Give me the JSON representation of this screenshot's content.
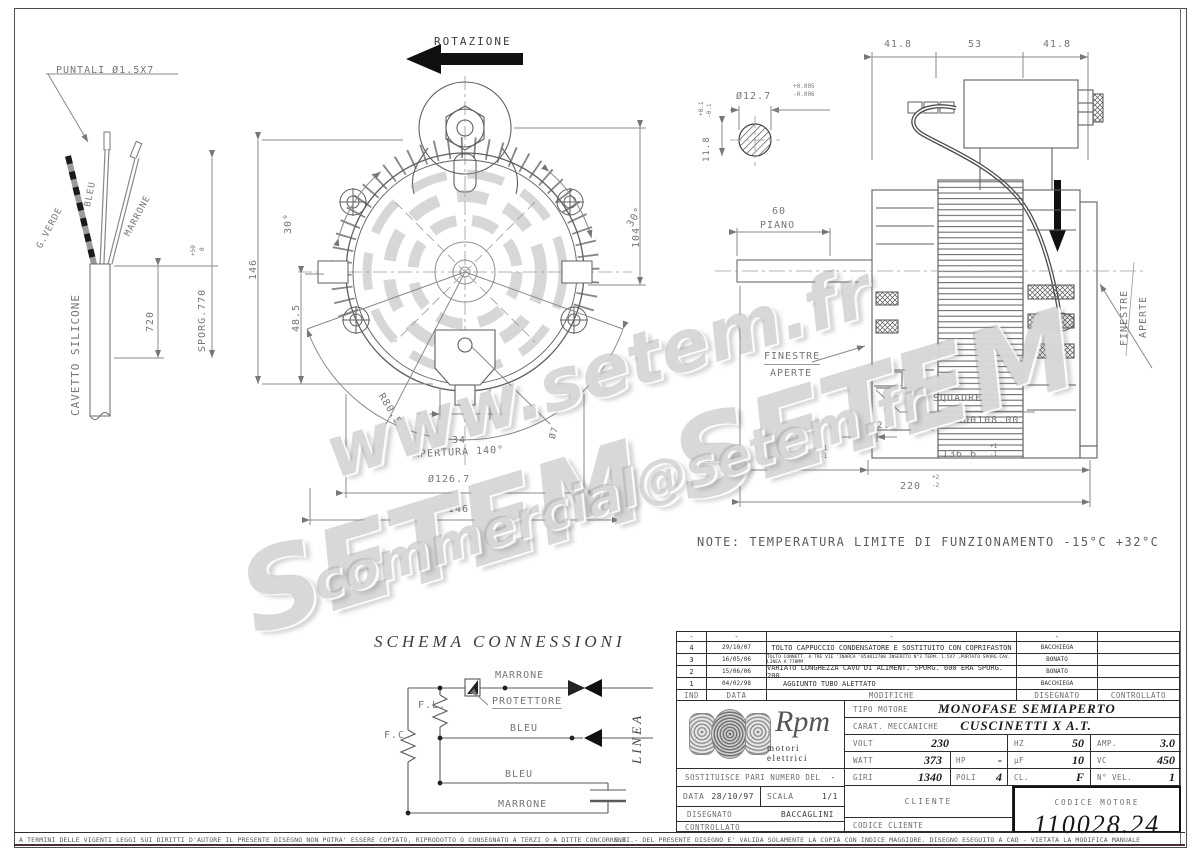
{
  "wm": {
    "line1": "www.setem.fr",
    "line2": "SETEM  SETEM",
    "line3": "commercial@setem.fr"
  },
  "cable": {
    "puntali": "PUNTALI Ø1.5X7",
    "g_verde": "G.VERDE",
    "bleu": "BLEU",
    "marrone": "MARRONE",
    "cavetto": "CAVETTO SILICONE",
    "d720": "720",
    "sporg": "SPORG.770",
    "sporg_tp": "+50",
    "sporg_tb": "0"
  },
  "front": {
    "rotazione": "ROTAZIONE",
    "d146l": "146",
    "d30l": "30°",
    "d48": "48.5",
    "d104": "104",
    "d30r": "30°",
    "r80": "R80.5",
    "d34": "34",
    "o7": "Ø7",
    "apertura": "APERTURA 140°",
    "o126": "Ø126.7",
    "d146b": "146"
  },
  "shaft": {
    "o127": "Ø12.7",
    "tol1a": "+0.005",
    "tol1b": "-0.006",
    "d118": "11.8",
    "tol2a": "+0.1",
    "tol2b": "-0.1"
  },
  "side": {
    "d418a": "41.8",
    "d53": "53",
    "d418b": "41.8",
    "d60": "60",
    "piano": "PIANO",
    "fin_l1": "FINESTRE",
    "fin_l2": "APERTE",
    "fin_r1": "FINESTRE",
    "fin_r2": "APERTE",
    "sq1": "SQUADRETTE",
    "sq2": "COD.300108.00",
    "d23": "2.3",
    "d834": "83.4",
    "t834a": "+1",
    "t834b": "-1",
    "d1366": "136.6",
    "t1366a": "+1",
    "t1366b": "-1",
    "d220": "220",
    "t220a": "+2",
    "t220b": "-2"
  },
  "note": "NOTE: TEMPERATURA LIMITE DI FUNZIONAMENTO -15°C +32°C",
  "schema": {
    "title": "SCHEMA CONNESSIONI",
    "marrone_top": "MARRONE",
    "protettore": "PROTETTORE",
    "fl": "F.L.",
    "fc": "F.C.",
    "bleu_mid": "BLEU",
    "bleu_low": "BLEU",
    "marrone_bot": "MARRONE",
    "linea": "LINEA"
  },
  "rev": {
    "hdr": {
      "ind": "IND",
      "data": "DATA",
      "mod": "MODIFICHE",
      "dis": "DISEGNATO",
      "con": "CONTROLLATO"
    },
    "rows": [
      {
        "ind": "-",
        "date": "-",
        "desc": "-",
        "by": "-"
      },
      {
        "ind": "4",
        "date": "29/10/07",
        "desc": "TOLTO CAPPUCCIO CONDENSATORE E SOSTITUITO CON COPRIFASTON",
        "by": "BACCHIEGA"
      },
      {
        "ind": "3",
        "date": "16/05/06",
        "desc": "TOLTO CONNETT. A TRE VIE 'INARCA '854012700 INSERITO N°3 TERM. 1.5X7 ,PORTATO SPORG.CAV. LINEA A 770MM",
        "by": "BONATO"
      },
      {
        "ind": "2",
        "date": "15/06/06",
        "desc": "VARIATO LUNGHEZZA CAVO DI ALIMENT. SPORG. 600 ERA SPORG. 200",
        "by": "BONATO"
      },
      {
        "ind": "1",
        "date": "04/02/98",
        "desc": "AGGIUNTO TUBO ALETTATO",
        "by": "BACCHIEGA"
      }
    ]
  },
  "tb": {
    "logo_main": "Rpm",
    "logo_sub": "motori elettrici",
    "sost_label": "SOSTITUISCE PARI NUMERO DEL",
    "sost": "-",
    "data_label": "DATA",
    "data": "28/10/97",
    "scala_label": "SCALA",
    "scala": "1/1",
    "disegnato_label": "DISEGNATO",
    "disegnato": "BACCAGLINI",
    "controllato_label": "CONTROLLATO",
    "tipo_label": "TIPO MOTORE",
    "tipo": "MONOFASE SEMIAPERTO",
    "carat_label": "CARAT. MECCANICHE",
    "carat": "CUSCINETTI X A.T.",
    "volt_label": "VOLT",
    "volt": "230",
    "hz_label": "HZ",
    "hz": "50",
    "amp_label": "AMP.",
    "amp": "3.0",
    "watt_label": "WATT",
    "watt": "373",
    "hp_label": "HP",
    "hp": "-",
    "uf_label": "µF",
    "uf": "10",
    "vc_label": "VC",
    "vc": "450",
    "giri_label": "GIRI",
    "giri": "1340",
    "poli_label": "POLI",
    "poli": "4",
    "cl_label": "CL.",
    "cl": "F",
    "nvel_label": "N° VEL.",
    "nvel": "1",
    "cliente_label": "CLIENTE",
    "codice_cliente_label": "CODICE CLIENTE",
    "codice_motore_label": "CODICE MOTORE",
    "codice_motore": "110028.24"
  },
  "footer": {
    "left": "A TERMINI DELLE VIGENTI LEGGI SUI DIRITTI D'AUTORE IL PRESENTE DISEGNO NON POTRA' ESSERE COPIATO, RIPRODOTTO O CONSEGNATO A TERZI O A DITTE CONCORRENTI.",
    "right": "N.B.  -  DEL PRESENTE DISEGNO E' VALIDA SOLAMENTE LA COPIA CON INDICE MAGGIORE.      DISEGNO ESEGUITO A CAD - VIETATA LA MODIFICA MANUALE"
  }
}
